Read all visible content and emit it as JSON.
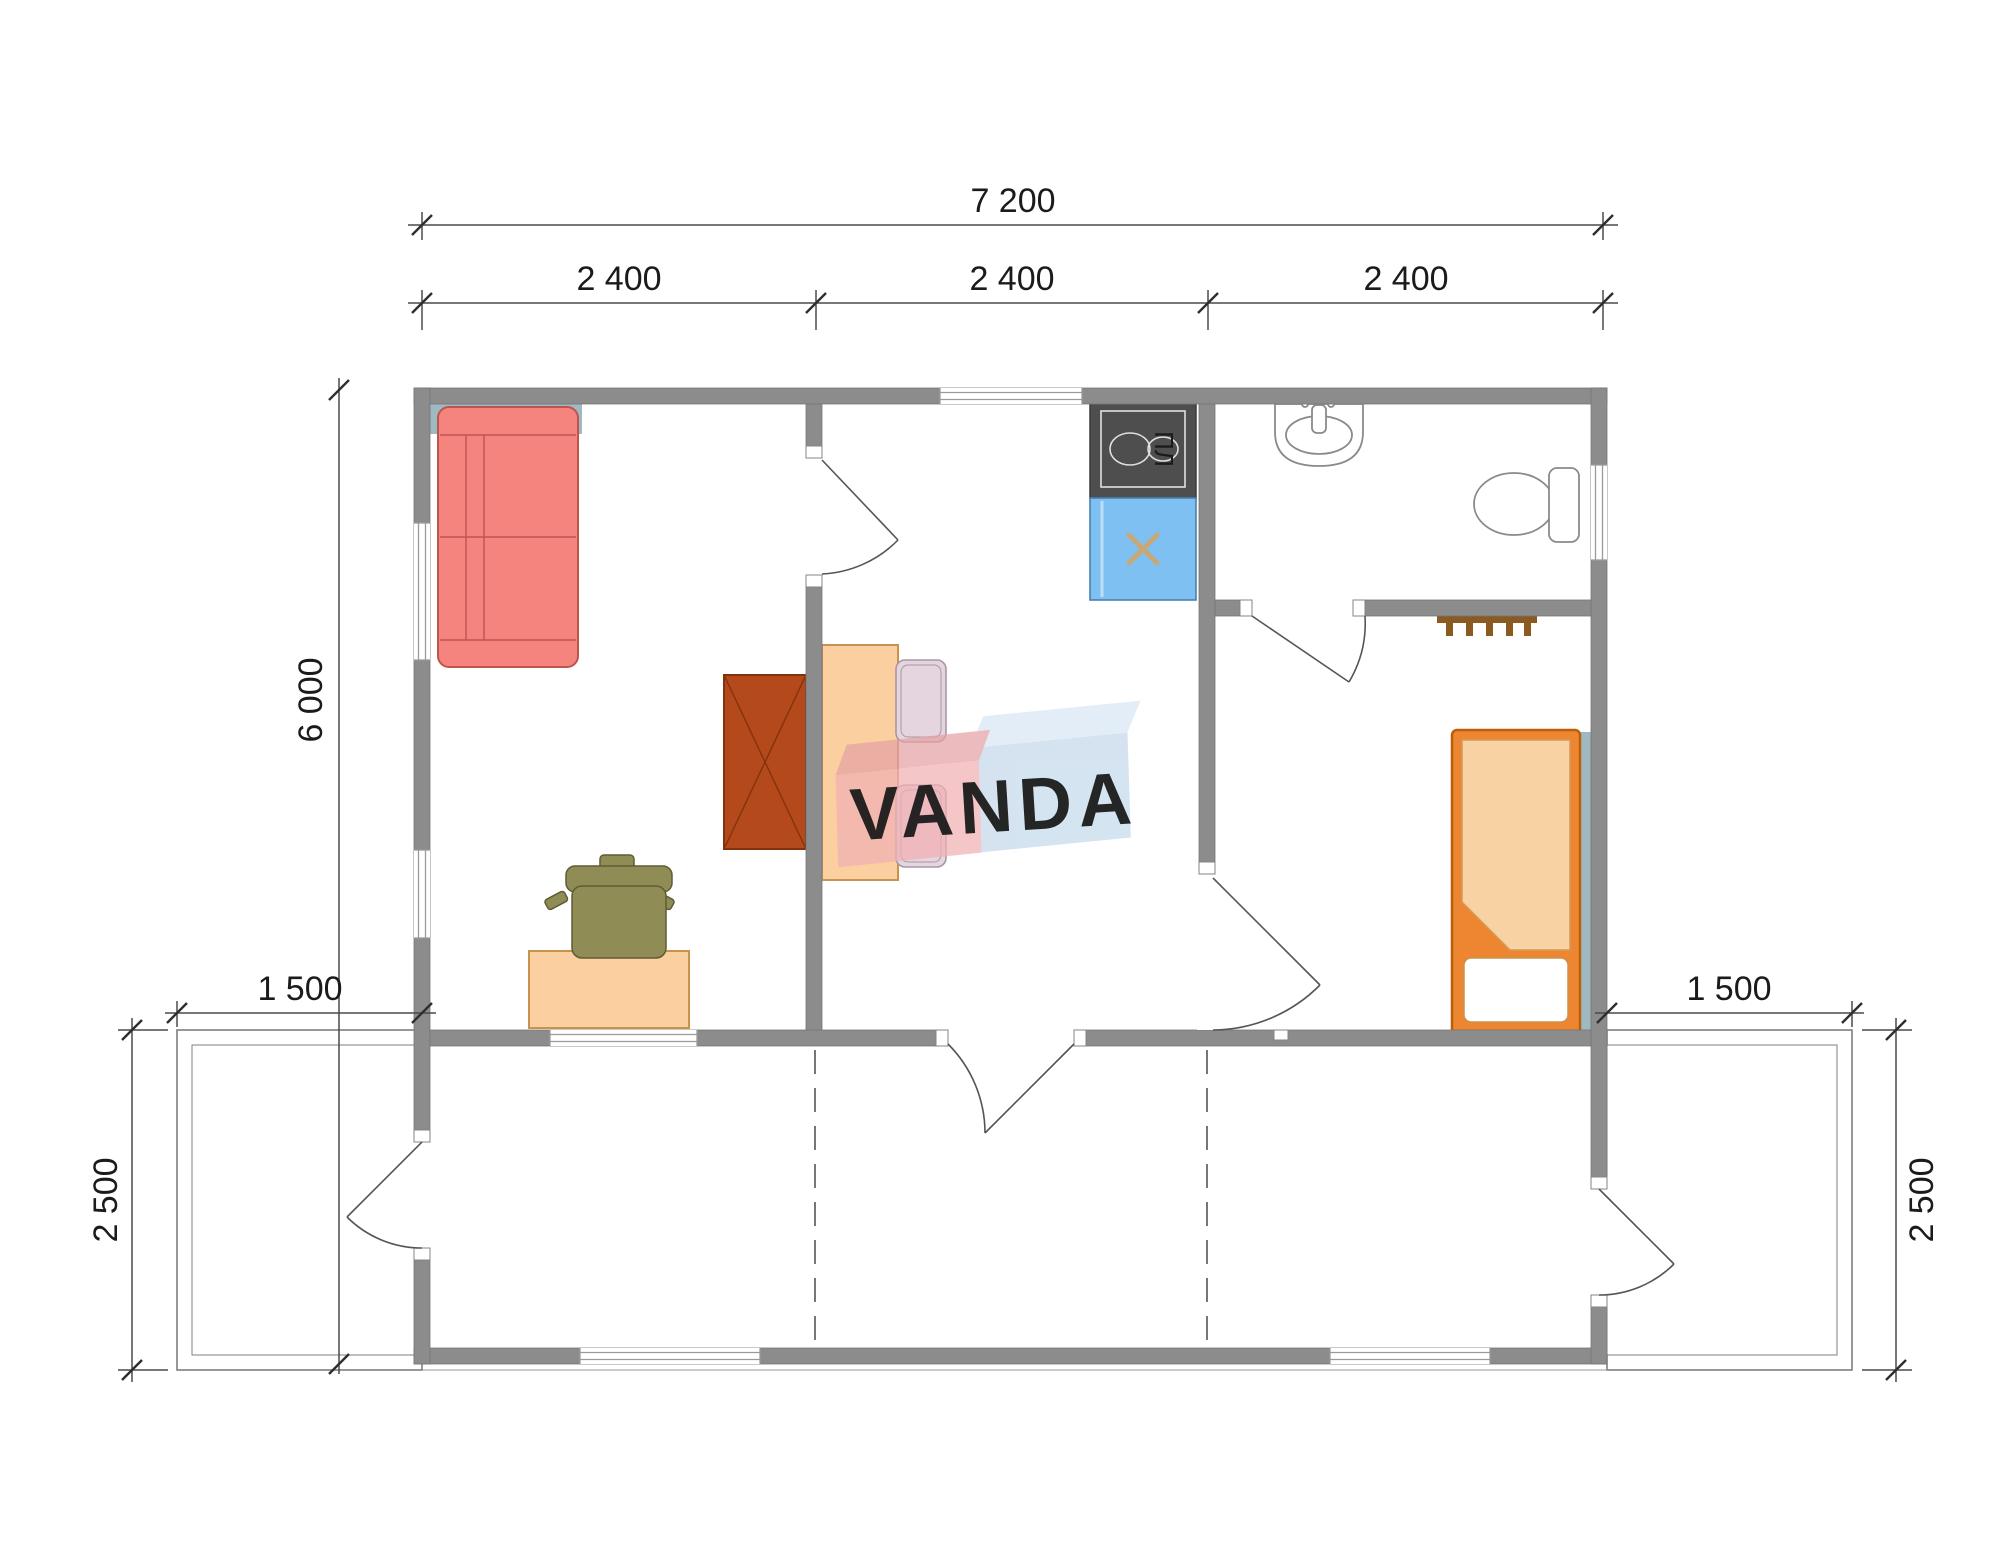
{
  "watermark": {
    "text": "VANDA",
    "red_block": "#F2B1B4",
    "red_bevel": "#E4A2A4",
    "blue_block": "#C5D9EC",
    "blue_bevel": "#D9E7F4",
    "text_color": "#FFFFFF"
  },
  "dimensions": {
    "total_width": "7 200",
    "bay_widths": [
      "2 400",
      "2 400",
      "2 400"
    ],
    "total_depth": "6 000",
    "terrace_left_width": "1 500",
    "terrace_right_width": "1 500",
    "terrace_left_depth": "2 500",
    "terrace_right_depth": "2 500"
  },
  "kitchen": {
    "stove_label": "ПЛ"
  },
  "colors": {
    "wall": "#8C8C8C",
    "sofa": "#F5837E",
    "sofa_outline": "#BE544E",
    "bed_frame": "#EE8531",
    "bed_blanket": "#F9D2A3",
    "table_desk": "#FBCF9F",
    "cabinet": "#B4491B",
    "kitchen_sink": "#7FC0F2",
    "stove": "#4E4E4E",
    "chair": "#E4D5DE",
    "desk_chair": "#8F8C55",
    "coat_rack": "#8A5A20",
    "accent_teal": "#9FB9C2"
  },
  "furniture_icons": [
    "corner-sofa",
    "wardrobe-cabinet",
    "dining-table",
    "dining-chairs",
    "stove",
    "kitchen-sink-cabinet",
    "wash-basin",
    "toilet",
    "coat-rack",
    "single-bed",
    "desk",
    "desk-chair"
  ]
}
